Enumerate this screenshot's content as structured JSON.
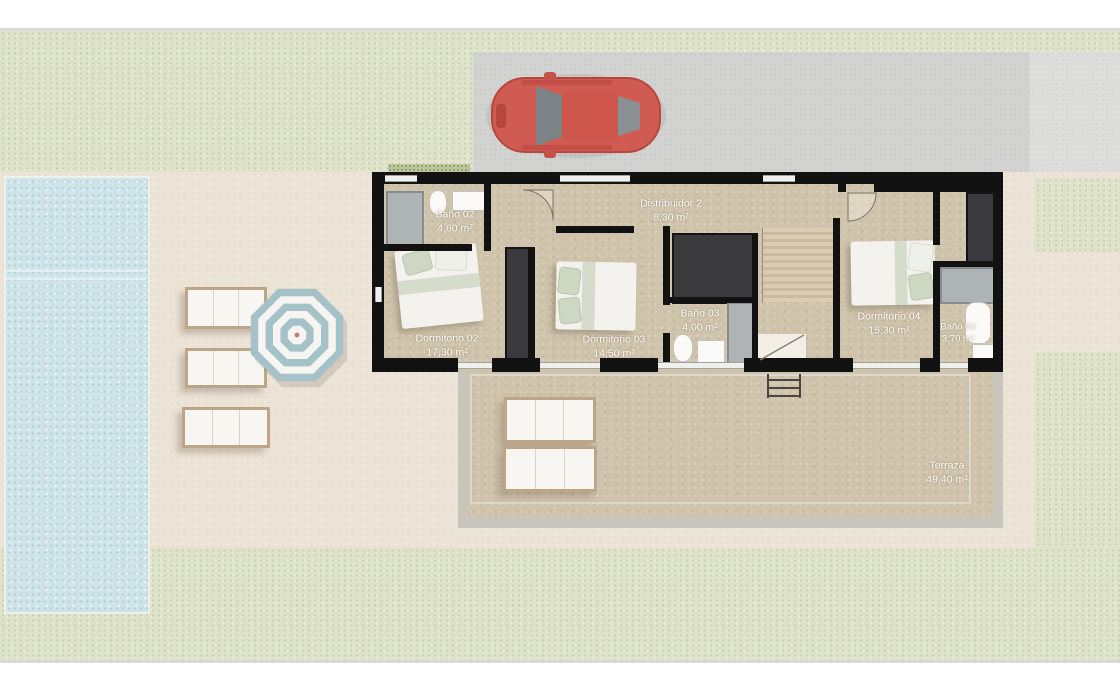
{
  "plan": {
    "rooms": [
      {
        "name": "Baño 02",
        "area": "4,60 m²"
      },
      {
        "name": "Distribuidor 2",
        "area": "8,30 m²"
      },
      {
        "name": "Dormitorio 02",
        "area": "17,30 m²"
      },
      {
        "name": "Dormitorio 03",
        "area": "14,50 m²"
      },
      {
        "name": "Baño 03",
        "area": "4,00 m²"
      },
      {
        "name": "Dormitorio 04",
        "area": "15,30 m²"
      },
      {
        "name": "Baño 04",
        "area": "3,70 m²"
      },
      {
        "name": "Terraza",
        "area": "49,40 m²"
      }
    ]
  },
  "objects": {
    "car": "red-car-top-view-icon",
    "pool": "swimming-pool",
    "umbrella": "parasol-umbrella-icon",
    "poolside_loungers": 3,
    "terrace_loungers": 2,
    "staircase": "staircase",
    "beds": 3,
    "bath_fixtures": [
      "shower",
      "toilet",
      "washbasin",
      "bathtub"
    ]
  },
  "colors": {
    "grass": "#dee3c9",
    "driveway": "#d3d3d1",
    "patio": "#ede4d8",
    "pool_water": "#cfe4e9",
    "plan_floor": "#cfc3ab",
    "walls": "#121212",
    "car_red": "#d05b52",
    "umbrella_blue": "#a6c2c9",
    "label_text": "#fdfdfa"
  }
}
